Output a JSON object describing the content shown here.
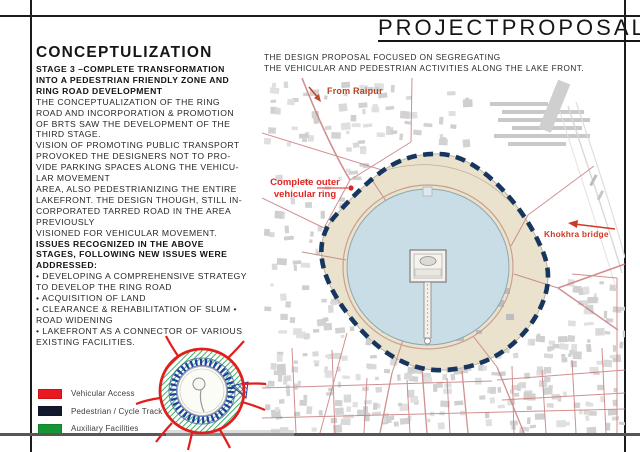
{
  "frame": {
    "title_words": [
      "PROJECT",
      "PROPOSAL"
    ]
  },
  "left_panel": {
    "heading": "CONCEPTULIZATION",
    "lines": [
      {
        "t": "STAGE 3 –COMPLETE TRANSFORMATION",
        "b": true
      },
      {
        "t": "INTO A PEDESTRIAN FRIENDLY ZONE AND",
        "b": true
      },
      {
        "t": "RING ROAD DEVELOPMENT",
        "b": true
      },
      {
        "t": "THE CONCEPTUALIZATION OF THE RING",
        "b": false
      },
      {
        "t": "ROAD AND INCORPORATION & PROMOTION",
        "b": false
      },
      {
        "t": "OF BRTS SAW THE DEVELOPMENT OF THE",
        "b": false
      },
      {
        "t": "THIRD STAGE.",
        "b": false
      },
      {
        "t": "VISION OF PROMOTING PUBLIC TRANSPORT",
        "b": false
      },
      {
        "t": "PROVOKED THE DESIGNERS NOT TO PRO-",
        "b": false
      },
      {
        "t": "VIDE PARKING SPACES ALONG THE VEHICU-",
        "b": false
      },
      {
        "t": "LAR MOVEMENT",
        "b": false
      },
      {
        "t": "AREA, ALSO PEDESTRIANIZING THE ENTIRE",
        "b": false
      },
      {
        "t": "LAKEFRONT. THE DESIGN THOUGH, STILL IN-",
        "b": false
      },
      {
        "t": "CORPORATED TARRED ROAD IN THE AREA",
        "b": false
      },
      {
        "t": "PREVIOUSLY",
        "b": false
      },
      {
        "t": "VISIONED FOR VEHICULAR MOVEMENT.",
        "b": false
      },
      {
        "t": "ISSUES RECOGNIZED IN THE ABOVE",
        "b": true
      },
      {
        "t": "STAGES, FOLLOWING NEW ISSUES WERE",
        "b": true
      },
      {
        "t": "ADDRESSED:",
        "b": true
      },
      {
        "t": "• DEVELOPING A COMPREHENSIVE STRATEGY",
        "b": false
      },
      {
        "t": "TO DEVELOP THE RING ROAD",
        "b": false
      },
      {
        "t": "• ACQUISITION OF LAND",
        "b": false
      },
      {
        "t": "• CLEARANCE & REHABILITATION OF SLUM •",
        "b": false
      },
      {
        "t": "ROAD WIDENING",
        "b": false
      },
      {
        "t": "• LAKEFRONT AS A CONNECTOR OF VARIOUS",
        "b": false
      },
      {
        "t": "EXISTING FACILITIES.",
        "b": false
      }
    ],
    "legend": [
      {
        "label": "Vehicular Access",
        "color": "#e8191f"
      },
      {
        "label": "Pedestrian / Cycle Track",
        "color": "#131a2e"
      },
      {
        "label": "Auxiliary Facilities",
        "color": "#169535"
      }
    ]
  },
  "map": {
    "intro": [
      "THE DESIGN PROPOSAL FOCUSED ON SEGREGATING",
      "THE VEHICULAR AND PEDESTRIAN ACTIVITIES ALONG THE LAKE FRONT."
    ],
    "labels": {
      "from_raipur": "From Raipur",
      "outer_ring_line1": "Complete outer",
      "outer_ring_line2": "vehicular ring",
      "bridge": "Khokhra bridge"
    },
    "colors": {
      "lake": "#c9dde6",
      "lakefront": "#eae2cc",
      "pedestrian_ring_dash": "#17365f",
      "road": "#c97c7c",
      "label_red": "#e02421",
      "raipur_label": "#b5431c"
    }
  }
}
